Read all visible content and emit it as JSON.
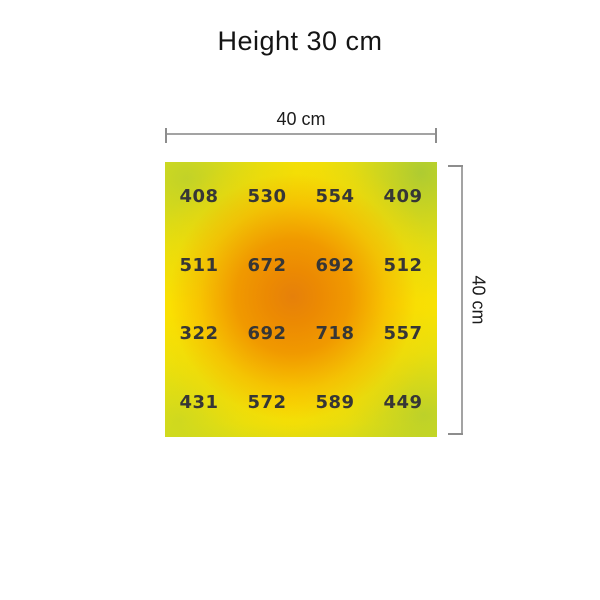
{
  "title": "Height 30 cm",
  "dimension_labels": {
    "width": "40 cm",
    "height": "40 cm"
  },
  "chart_data": {
    "type": "heatmap",
    "title": "Height 30 cm",
    "rows": 4,
    "cols": 4,
    "area_width_label": "40 cm",
    "area_height_label": "40 cm",
    "values": [
      [
        408,
        530,
        554,
        409
      ],
      [
        511,
        672,
        692,
        512
      ],
      [
        322,
        692,
        718,
        557
      ],
      [
        431,
        572,
        589,
        449
      ]
    ],
    "value_min": 322,
    "value_max": 718,
    "legend": "none",
    "colors": {
      "low": "#c3d838",
      "mid": "#fbe600",
      "high": "#e6800a",
      "value_text": "#363636",
      "dimension_line": "#a3a3a3"
    }
  }
}
